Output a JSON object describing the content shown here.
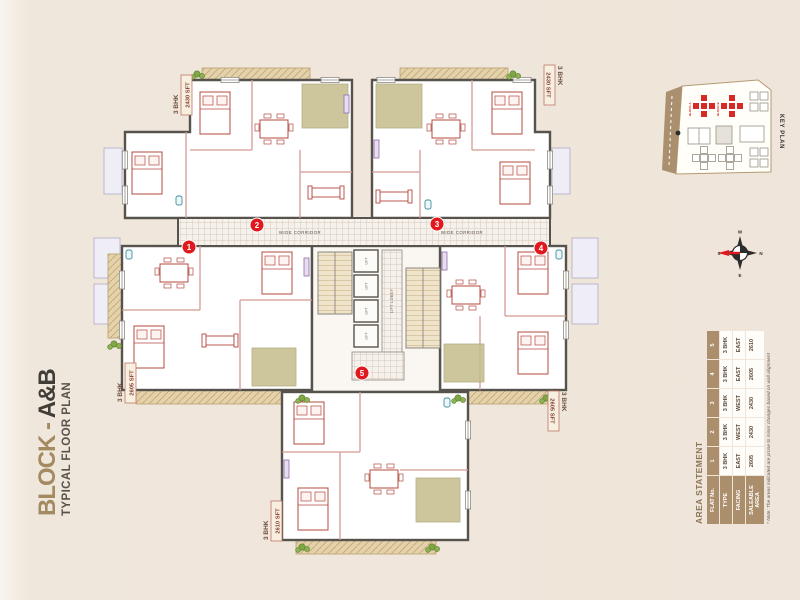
{
  "page": {
    "title_prefix": "BLOCK - ",
    "title_emphasis": "A&B",
    "subtitle": "TYPICAL FLOOR PLAN"
  },
  "key_plan": {
    "label": "KEY PLAN",
    "block_a_label": "BLOCK A",
    "block_b_label": "BLOCK B"
  },
  "compass": {
    "top": "W",
    "right": "N",
    "bottom": "E",
    "left": "S"
  },
  "plan": {
    "corridor_label": "WIDE CORRIDOR",
    "lift_label": "LIFT",
    "lift_lobby_label": "LIFT LOBBY",
    "flat_badges": [
      "1",
      "2",
      "3",
      "4",
      "5"
    ],
    "unit_labels": [
      {
        "position": "top-left",
        "type": "3 BHK",
        "area": "2430 SFT"
      },
      {
        "position": "top-right",
        "type": "3 BHK",
        "area": "2430 SFT"
      },
      {
        "position": "middle-left",
        "type": "3 BHK",
        "area": "2605 SFT"
      },
      {
        "position": "middle-right",
        "type": "3 BHK",
        "area": "2605 SFT"
      },
      {
        "position": "bottom",
        "type": "3 BHK",
        "area": "2610 SFT"
      }
    ]
  },
  "area_statement": {
    "title": "AREA STATEMENT",
    "row_headers": [
      "FLAT No.",
      "TYPE",
      "FACING",
      "SALEABLE AREA"
    ],
    "flat_numbers": [
      "1",
      "2",
      "3",
      "4",
      "5"
    ],
    "type_row": [
      "3 BHK",
      "3 BHK",
      "3 BHK",
      "3 BHK",
      "3 BHK"
    ],
    "facing_row": [
      "EAST",
      "WEST",
      "WEST",
      "EAST",
      "EAST"
    ],
    "area_row": [
      "2605",
      "2430",
      "2430",
      "2605",
      "2610"
    ],
    "note": "* Note: The areas indicated are prone to minor changes based on wall alignment"
  },
  "colors": {
    "background": "#efe5da",
    "accent_tan": "#ab8e6c",
    "badge_red": "#e0191f",
    "wall": "#56524c",
    "partition_pink": "#d49a94",
    "kitchen_olive": "#c5bd8d",
    "balcony_tan": "#e3d2ab"
  }
}
